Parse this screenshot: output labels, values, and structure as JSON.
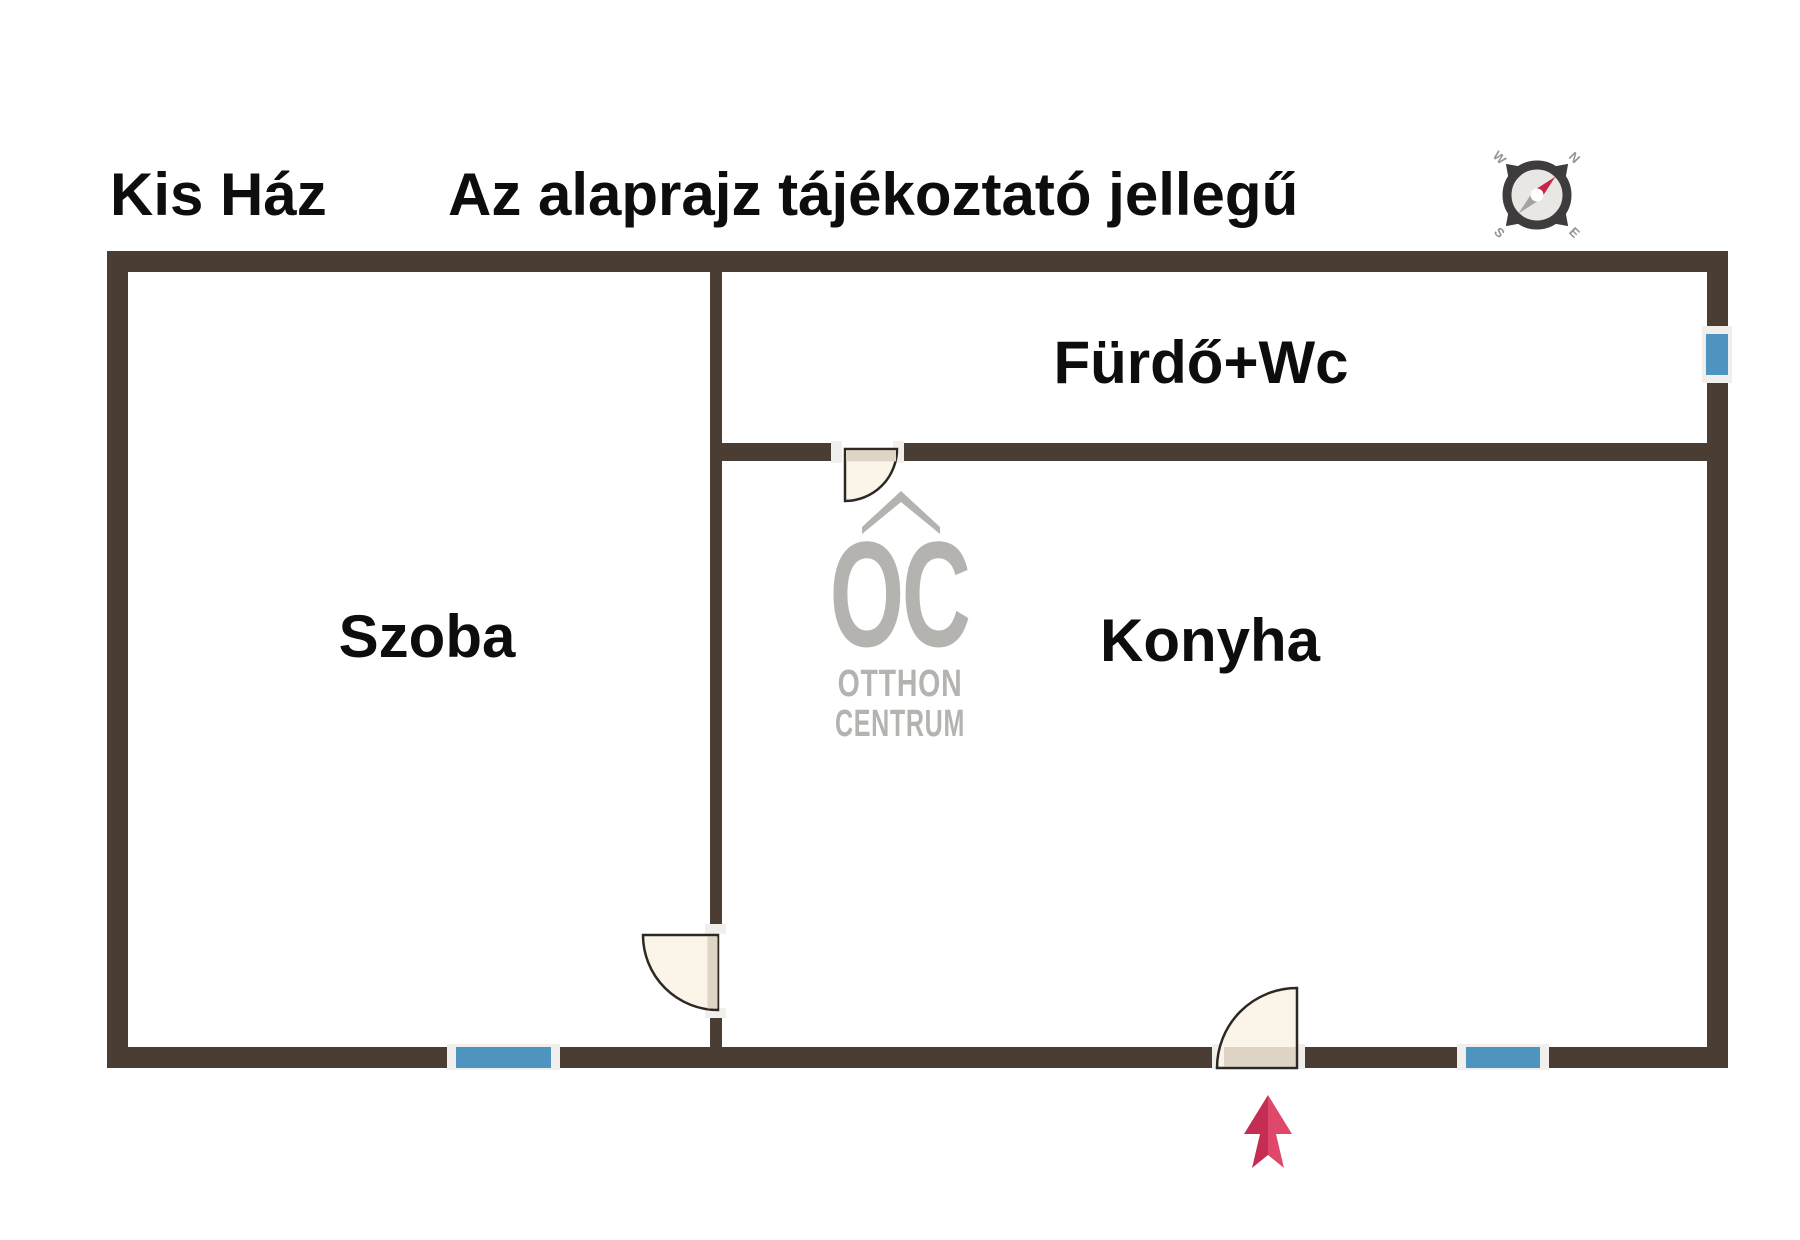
{
  "header": {
    "title": "Kis Ház",
    "disclaimer": "Az alaprajz tájékoztató jellegű"
  },
  "rooms": {
    "left": "Szoba",
    "top_right": "Fürdő+Wc",
    "bottom_right": "Konyha"
  },
  "watermark": {
    "monogram": "OC",
    "line1": "OTTHON",
    "line2": "CENTRUM"
  },
  "compass": {
    "north": "N",
    "east": "E",
    "south": "S",
    "west": "W"
  },
  "colors": {
    "wall": "#493d34",
    "window": "#4e94c1",
    "door-fill": "#fbf4e9",
    "door-leaf": "#ded5c6",
    "door-stroke": "#2e2823",
    "jamb": "#f1efec",
    "arrow-dark": "#c62d54",
    "arrow-light": "#e0486b",
    "watermark": "#b5b3b0",
    "ring": "#3e3c3d",
    "face": "#e9e7e4",
    "letter": "#949494",
    "needle-red": "#c9244b",
    "needle-gray": "#a5a2a0"
  }
}
